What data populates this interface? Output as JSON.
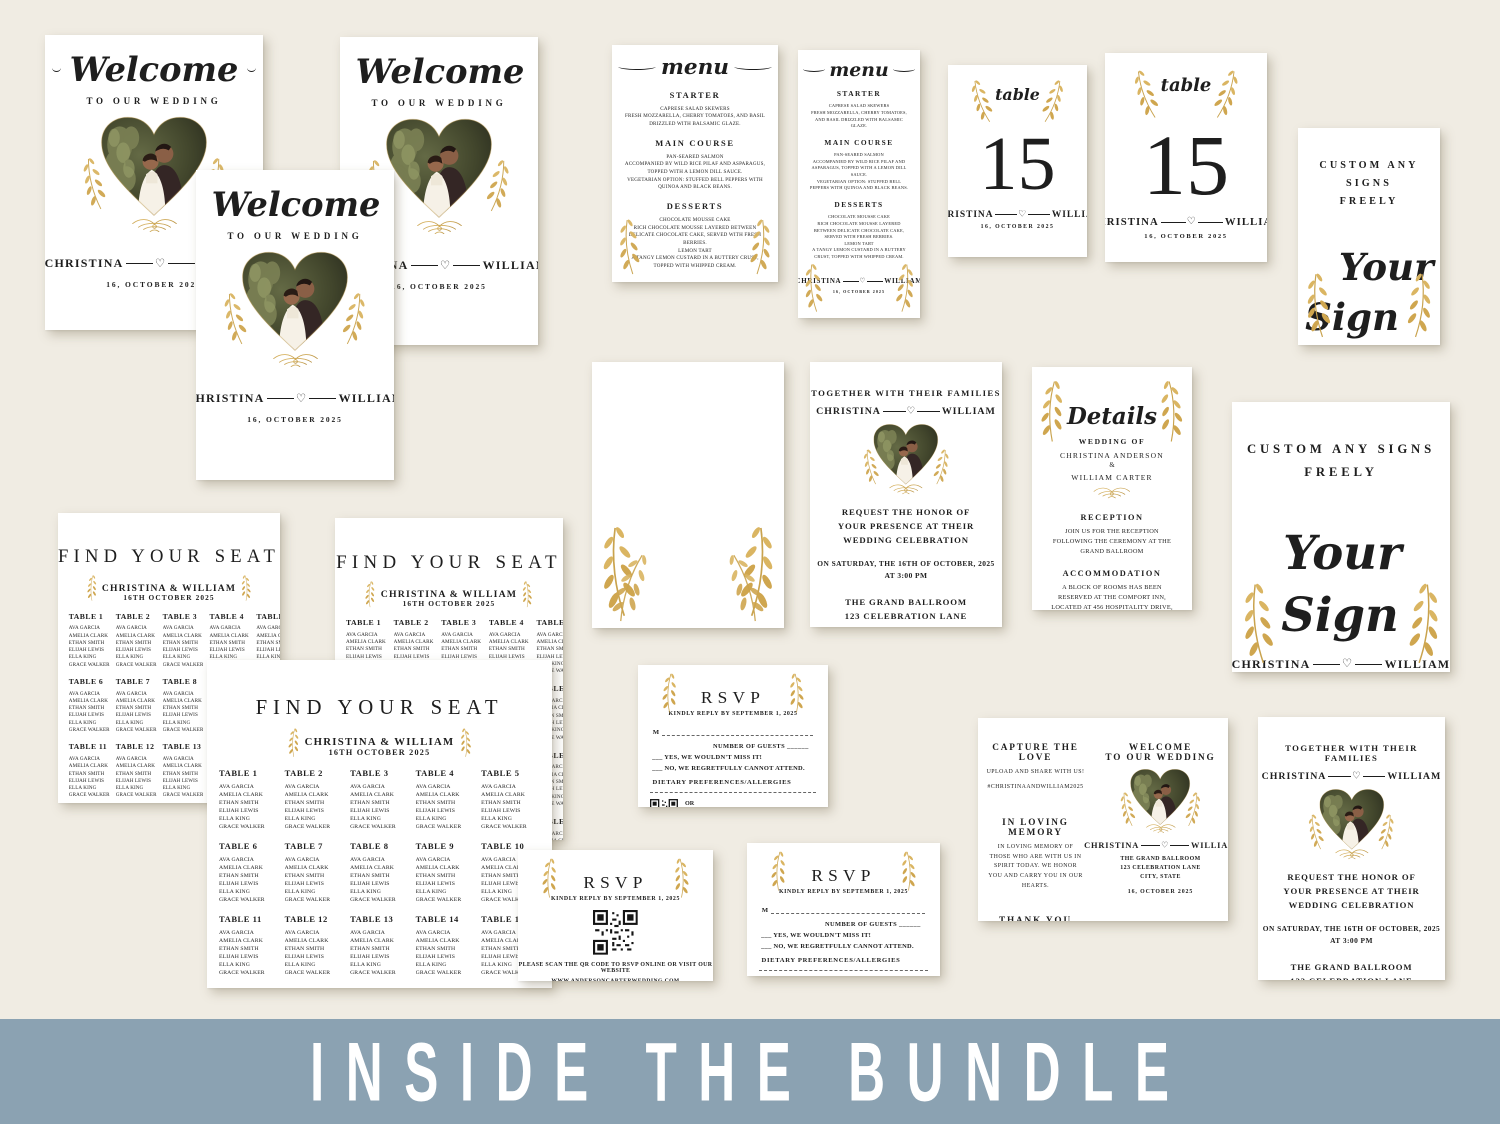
{
  "page": {
    "background_color": "#f0ece3"
  },
  "banner": {
    "label": "INSIDE THE BUNDLE",
    "background_color": "#8ba2b2"
  },
  "colors": {
    "gold": "#c9a34e",
    "ink": "#1e1e1e",
    "card": "#ffffff"
  },
  "icons": {
    "heart": "♡"
  },
  "couple": {
    "name1": "CHRISTINA",
    "name2": "WILLIAM",
    "names_amp": "CHRISTINA & WILLIAM",
    "date": "16, OCTOBER 2025",
    "date_numeric": "16.10.2025",
    "monogram": "C & W"
  },
  "welcome_sign": {
    "title": "Welcome",
    "subtitle": "TO OUR WEDDING"
  },
  "menu_card": {
    "title": "menu",
    "sections": [
      {
        "heading": "STARTER",
        "body": "CAPRESE SALAD SKEWERS\nFRESH MOZZARELLA, CHERRY TOMATOES, AND BASIL DRIZZLED WITH BALSAMIC GLAZE."
      },
      {
        "heading": "MAIN COURSE",
        "body": "PAN-SEARED SALMON\nACCOMPANIED BY WILD RICE PILAF AND ASPARAGUS, TOPPED WITH A LEMON DILL SAUCE.\nVEGETARIAN OPTION: STUFFED BELL PEPPERS WITH QUINOA AND BLACK BEANS."
      },
      {
        "heading": "DESSERTS",
        "body": "CHOCOLATE MOUSSE CAKE\nRICH CHOCOLATE MOUSSE LAYERED BETWEEN DELICATE CHOCOLATE CAKE, SERVED WITH FRESH BERRIES.\nLEMON TART\nA TANGY LEMON CUSTARD IN A BUTTERY CRUST, TOPPED WITH WHIPPED CREAM."
      }
    ]
  },
  "table_card": {
    "label": "table",
    "number": "15"
  },
  "custom_sign": {
    "heading": "CUSTOM ANY SIGNS\nFREELY",
    "script_line1": "Your",
    "script_line2": "Sign"
  },
  "invitation": {
    "intro": "TOGETHER WITH THEIR FAMILIES",
    "request": "REQUEST THE HONOR OF YOUR PRESENCE AT THEIR WEDDING CELEBRATION",
    "datetime": "ON SATURDAY, THE 16TH OF OCTOBER, 2025\nAT 3:00 PM",
    "venue": "THE GRAND BALLROOM\n123 CELEBRATION LANE\nCITY, STATE",
    "footer": "RECEPTION TO FOLLOW"
  },
  "details_card": {
    "title": "Details",
    "wedding_of_label": "WEDDING OF",
    "bride_full": "CHRISTINA ANDERSON",
    "ampersand": "&",
    "groom_full": "WILLIAM CARTER",
    "reception_heading": "RECEPTION",
    "reception_body": "JOIN US FOR THE RECEPTION FOLLOWING THE CEREMONY AT THE GRAND BALLROOM",
    "accommodation_heading": "ACCOMMODATION",
    "accommodation_body": "A BLOCK OF ROOMS HAS BEEN RESERVED AT THE COMFORT INN, LOCATED AT 456 HOSPITALITY DRIVE, CITY, STATE. PLEASE MENTION 'ANDERSON-CARTER WEDDING' WHEN BOOKING TO RECEIVE THE GROUP RATE.",
    "website_note": "FOR MORE DETAILS, VISIT OUR WEDDING WEBSITE AT\nWWW.ANDERSONCARTERWEDDING.COM"
  },
  "seating_chart": {
    "title": "FIND YOUR SEAT",
    "subtitle": "CHRISTINA & WILLIAM",
    "date": "16TH OCTOBER 2025",
    "tables": [
      "TABLE 1",
      "TABLE 2",
      "TABLE 3",
      "TABLE 4",
      "TABLE 5",
      "TABLE 6",
      "TABLE 7",
      "TABLE 8",
      "TABLE 9",
      "TABLE 10",
      "TABLE 11",
      "TABLE 12",
      "TABLE 13",
      "TABLE 14",
      "TABLE 15",
      "TABLE 16",
      "TABLE 17",
      "TABLE 18",
      "TABLE 19",
      "TABLE 20"
    ],
    "guests": [
      "AVA GARCIA",
      "AMELIA CLARK",
      "ETHAN SMITH",
      "ELIJAH LEWIS",
      "ELLA KING",
      "GRACE WALKER"
    ]
  },
  "rsvp": {
    "title": "RSVP",
    "reply_by": "KINDLY REPLY BY SEPTEMBER 1, 2025",
    "name_prefix": "M",
    "guests_label": "NUMBER OF GUESTS ______",
    "yes_option": "___ YES, WE WOULDN'T MISS IT!",
    "no_option": "___ NO, WE REGRETFULLY CANNOT ATTEND.",
    "dietary_label": "DIETARY PREFERENCES/ALLERGIES",
    "or_label": "OR",
    "scan_label": "SCAN THE QR CODE TO RSVP ONLINE",
    "scan_label_long": "PLEASE SCAN THE QR CODE TO RSVP ONLINE OR VISIT OUR WEBSITE",
    "website": "WWW.ANDERSONCARTERWEDDING.COM"
  },
  "program_card": {
    "capture_heading": "CAPTURE THE LOVE",
    "capture_body": "UPLOAD AND SHARE WITH US!",
    "hashtag": "#CHRISTINAANDWILLIAM2025",
    "memory_heading": "IN LOVING MEMORY",
    "memory_body": "IN LOVING MEMORY OF THOSE WHO ARE WITH US IN SPIRIT TODAY. WE HONOR YOU AND CARRY YOU IN OUR HEARTS.",
    "thanks_heading": "THANK YOU",
    "thanks_body": "WE ARE DEEPLY GRATEFUL FOR YOUR LOVE AND SUPPORT AS WE CELEBRATE THIS SPECIAL DAY. YOUR PRESENCE MEANS THE WORLD TO US!",
    "welcome_heading": "WELCOME\nTO OUR WEDDING"
  }
}
